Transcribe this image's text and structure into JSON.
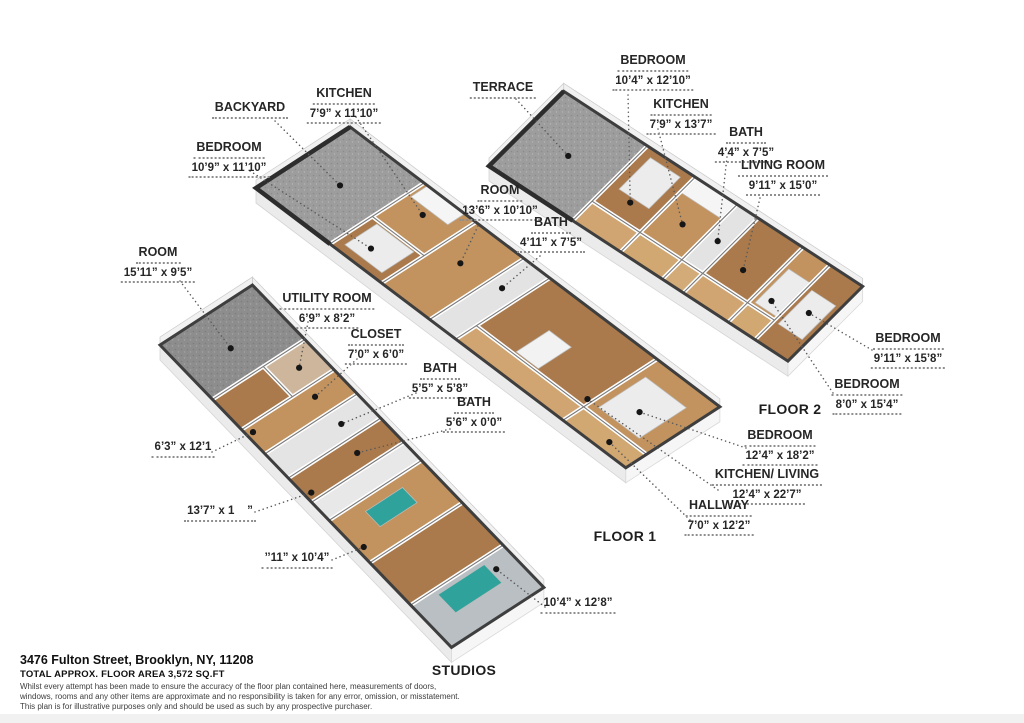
{
  "colors": {
    "wood_a": "#aa7a4c",
    "wood_b": "#c2935f",
    "wood_corridor": "#d2a873",
    "terrace_gray": "#9d9d9d",
    "accent_teal": "#2fa39b",
    "wall_dark": "#3e3e3e"
  },
  "floor2": {
    "title": "FLOOR 2",
    "labels": {
      "bedroom1": {
        "name": "BEDROOM",
        "dims": "10’4” x 12’10”"
      },
      "terrace": {
        "name": "TERRACE"
      },
      "kitchen": {
        "name": "KITCHEN",
        "dims": "7’9” x 13’7”"
      },
      "bath": {
        "name": "BATH",
        "dims": "4’4” x 7’5”"
      },
      "living": {
        "name": "LIVING ROOM",
        "dims": "9’11” x 15’0”"
      },
      "bedroom2": {
        "name": "BEDROOM",
        "dims": "9’11” x 15’8”"
      },
      "bedroom3": {
        "name": "BEDROOM",
        "dims": "8’0” x 15’4”"
      }
    }
  },
  "floor1": {
    "title": "FLOOR 1",
    "labels": {
      "backyard": {
        "name": "BACKYARD"
      },
      "kitchen": {
        "name": "KITCHEN",
        "dims": "7’9” x 11’10”"
      },
      "bedroom1": {
        "name": "BEDROOM",
        "dims": "10’9” x 11’10”"
      },
      "room": {
        "name": "ROOM",
        "dims": "13’6” x 10’10”"
      },
      "bath": {
        "name": "BATH",
        "dims": "4’11” x 7’5”"
      },
      "bedroom2": {
        "name": "BEDROOM",
        "dims": "12’4” x 18’2”"
      },
      "kitchenliving": {
        "name": "KITCHEN/ LIVING",
        "dims": "12’4” x 22’7”"
      },
      "hallway": {
        "name": "HALLWAY",
        "dims": "7’0” x 12’2”"
      }
    }
  },
  "studios": {
    "title": "STUDIOS",
    "labels": {
      "room": {
        "name": "ROOM",
        "dims": "15’11” x 9’5”"
      },
      "utility": {
        "name": "UTILITY ROOM",
        "dims": "6’9” x 8’2”"
      },
      "closet": {
        "name": "CLOSET",
        "dims": "7’0” x 6’0”"
      },
      "bath1": {
        "name": "BATH",
        "dims": "5’5” x 5’8”"
      },
      "bath2": {
        "name": "BATH",
        "dims": "5’6” x 0’0”"
      },
      "dim1": {
        "dims": "6’3” x 12’1"
      },
      "dim2": {
        "dims": "13’7” x 1    ”"
      },
      "dim3": {
        "dims": "’’11” x 10’4”"
      },
      "dim4": {
        "dims": "10’4” x 12’8”"
      }
    }
  },
  "footer": {
    "address": "3476 Fulton Street, Brooklyn, NY, 11208",
    "area": "TOTAL APPROX. FLOOR AREA 3,572 SQ.FT",
    "disclaimer": [
      "Whilst every attempt has been made to ensure the accuracy of the floor plan contained here, measurements of doors,",
      "windows, rooms and any other items are approximate and no responsibility is taken for any error, omission, or misstatement.",
      "This plan is for illustrative purposes only and should be used as such by any prospective purchaser."
    ]
  }
}
